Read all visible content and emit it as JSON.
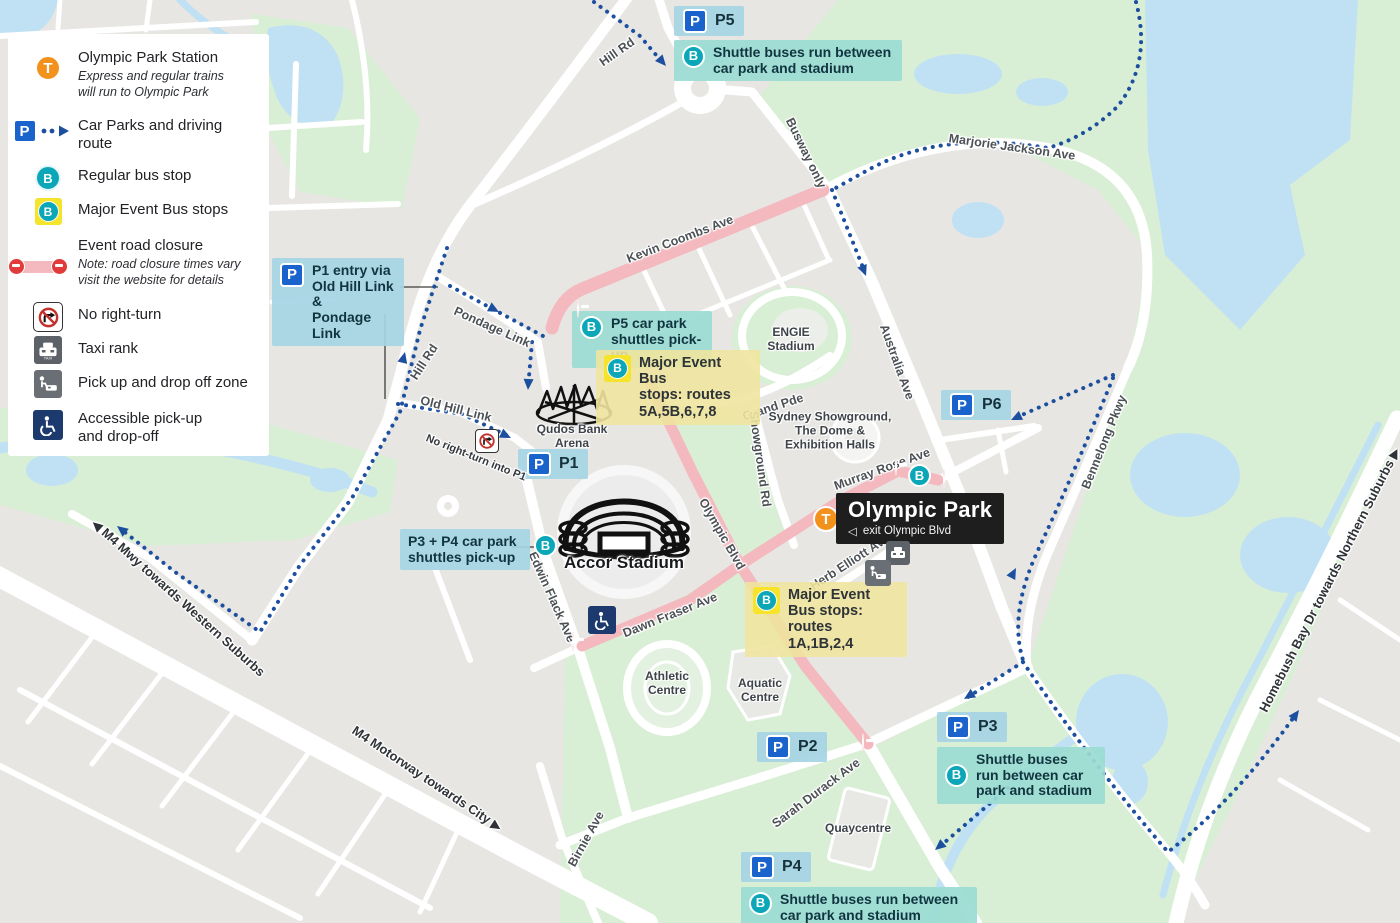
{
  "colors": {
    "map_bg": "#e7e6e3",
    "park_green": "#d9efd5",
    "water_blue": "#bfe1f3",
    "road_white": "#ffffff",
    "closure_pink": "#f4b9bf",
    "route_blue": "#1d4f9f",
    "bus_teal": "#0ba7b9",
    "parking_blue": "#1b63cc",
    "train_orange": "#f2911c",
    "major_event_yellow": "#f6e32b",
    "station_box": "#1e1e1e",
    "callout_blue": "#a6d4e4",
    "callout_teal": "#9bdbd3",
    "callout_yellow": "#eee49e"
  },
  "icons": {
    "train_letter": "T",
    "parking_letter": "P",
    "bus_letter": "B",
    "taxi_text": "TAXI",
    "exit_arrow": "◁",
    "arrow_west": "◀",
    "arrow_east": "▶"
  },
  "legend": {
    "items": [
      {
        "label": "Olympic Park Station",
        "note": "Express and regular trains\nwill run to Olympic Park"
      },
      {
        "label": "Car Parks and driving\nroute"
      },
      {
        "label": "Regular bus stop"
      },
      {
        "label": "Major Event Bus stops"
      },
      {
        "label": "Event road closure",
        "note": "Note: road closure times vary\nvisit the website for details"
      },
      {
        "label": "No right-turn"
      },
      {
        "label": "Taxi rank"
      },
      {
        "label": "Pick up and drop off zone"
      },
      {
        "label": "Accessible pick-up\nand drop-off"
      }
    ]
  },
  "station": {
    "title": "Olympic Park",
    "exit": "exit Olympic Blvd"
  },
  "badges": {
    "p1": "P1",
    "p2": "P2",
    "p3": "P3",
    "p4": "P4",
    "p5": "P5",
    "p6": "P6"
  },
  "callouts": {
    "p5_shuttle": "Shuttle buses run between\ncar park and stadium",
    "p4_shuttle": "Shuttle buses run between\ncar park and stadium",
    "p3_shuttle": "Shuttle buses\nrun between car\npark and stadium",
    "p1_entry": "P1 entry via\nOld Hill Link &\nPondage Link",
    "p5_pickup": "P5 car park\nshuttles pick-up",
    "p34_pickup": "P3 + P4 car park\nshuttles pick-up",
    "major_event_north": "Major Event Bus\nstops: routes\n5A,5B,6,7,8",
    "major_event_south": "Major Event\nBus stops:\nroutes 1A,1B,2,4",
    "no_right_turn_p1": "No right-turn\ninto P1"
  },
  "roads": {
    "hill_rd": "Hill Rd",
    "pondage": "Pondage Link",
    "old_hill": "Old Hill Link",
    "kevin": "Kevin Coombs Ave",
    "busway": "Busway only",
    "marjorie": "Marjorie Jackson Ave",
    "australia": "Australia Ave",
    "grand": "Grand Pde",
    "showground_rd": "Showground Rd",
    "murray": "Murray Rose Ave",
    "bennelong": "Bennelong Pkwy",
    "herb": "Herb Elliott Ave",
    "olympic_blvd": "Olympic Blvd",
    "edwin": "Edwin Flack Ave",
    "dawn": "Dawn Fraser Ave",
    "sarah": "Sarah Durack Ave",
    "birnie": "Birnie Ave",
    "m4_west": "M4 Mwy towards Western Suburbs",
    "m4_city": "M4 Motorway towards City",
    "homebush": "Homebush Bay Dr towards Northern Suburbs"
  },
  "places": {
    "engie": "ENGIE\nStadium",
    "showground": "Sydney Showground,\nThe Dome &\nExhibition Halls",
    "qudos": "Qudos Bank\nArena",
    "accor": "Accor Stadium",
    "athletic": "Athletic\nCentre",
    "aquatic": "Aquatic\nCentre",
    "quay": "Quaycentre"
  }
}
